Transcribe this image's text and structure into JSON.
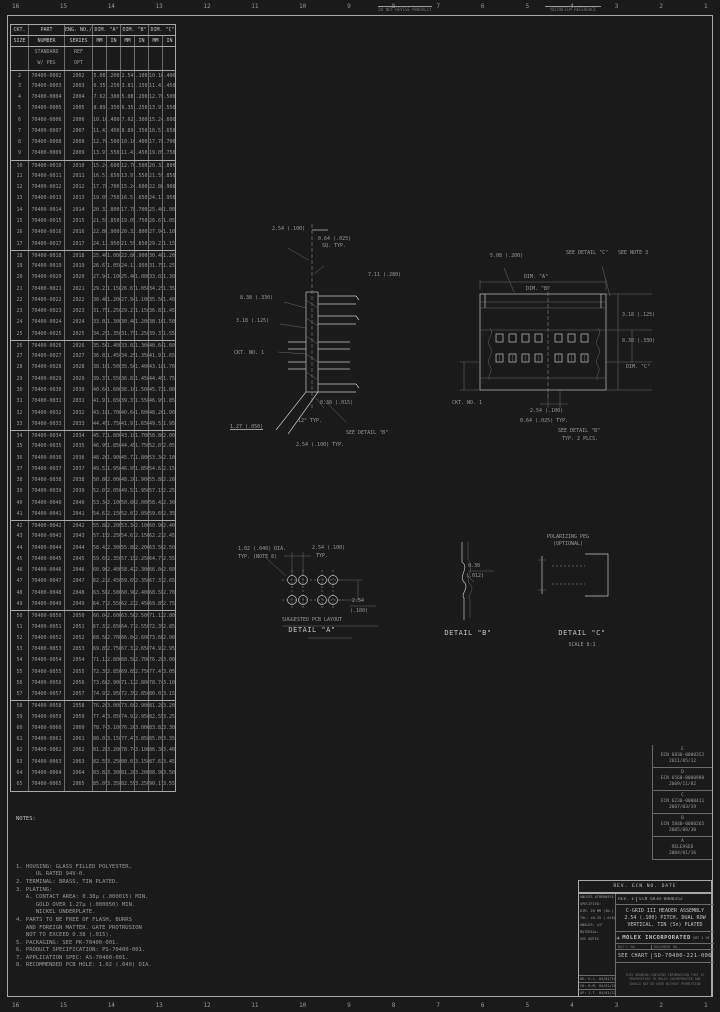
{
  "colors": {
    "bg": "#1a1a1a",
    "ink": "#c4c4c4",
    "dim": "#9a9a9a",
    "faint": "#707070",
    "line": "#a8a8a8",
    "grid": "#6b6b6b"
  },
  "border": {
    "zones": [
      "16",
      "15",
      "14",
      "13",
      "12",
      "11",
      "10",
      "9",
      "8",
      "7",
      "6",
      "5",
      "4",
      "3",
      "2",
      "1"
    ],
    "micro1": "DO NOT REVISE MANUALLY",
    "micro2": "MICROFILM REFERENCE"
  },
  "table": {
    "h1": {
      "ckt": "CKT.",
      "part": "PART",
      "eng": "ENG. NO./",
      "a": "DIM. \"A\"",
      "b": "DIM. \"B\"",
      "c": "DIM. \"C\""
    },
    "h2": {
      "ckt": "SIZE",
      "part": "NUMBER",
      "eng": "SERIES",
      "mm": "MM",
      "in": "IN"
    },
    "separators": [
      2,
      10,
      18,
      26,
      34,
      42,
      50,
      58
    ],
    "rows": [
      [
        "",
        "STANDARD",
        "REF",
        "",
        "",
        "",
        "",
        "",
        ""
      ],
      [
        "",
        "W/ PEG",
        "OPT",
        "",
        "",
        "",
        "",
        "",
        ""
      ],
      [
        "2",
        "70400-0002",
        "2002",
        "5.08",
        ".200",
        "2.54",
        ".100",
        "10.16",
        ".400"
      ],
      [
        "3",
        "70400-0003",
        "2003",
        "6.35",
        ".250",
        "3.81",
        ".150",
        "11.43",
        ".450"
      ],
      [
        "4",
        "70400-0004",
        "2004",
        "7.62",
        ".300",
        "5.08",
        ".200",
        "12.70",
        ".500"
      ],
      [
        "5",
        "70400-0005",
        "2005",
        "8.89",
        ".350",
        "6.35",
        ".250",
        "13.97",
        ".550"
      ],
      [
        "6",
        "70400-0006",
        "2006",
        "10.16",
        ".400",
        "7.62",
        ".300",
        "15.24",
        ".600"
      ],
      [
        "7",
        "70400-0007",
        "2007",
        "11.43",
        ".450",
        "8.89",
        ".350",
        "16.51",
        ".650"
      ],
      [
        "8",
        "70400-0008",
        "2008",
        "12.70",
        ".500",
        "10.16",
        ".400",
        "17.78",
        ".700"
      ],
      [
        "9",
        "70400-0009",
        "2009",
        "13.97",
        ".550",
        "11.43",
        ".450",
        "19.05",
        ".750"
      ],
      [
        "10",
        "70400-0010",
        "2010",
        "15.24",
        ".600",
        "12.70",
        ".500",
        "20.32",
        ".800"
      ],
      [
        "11",
        "70400-0011",
        "2011",
        "16.51",
        ".650",
        "13.97",
        ".550",
        "21.59",
        ".850"
      ],
      [
        "12",
        "70400-0012",
        "2012",
        "17.78",
        ".700",
        "15.24",
        ".600",
        "22.86",
        ".900"
      ],
      [
        "13",
        "70400-0013",
        "2013",
        "19.05",
        ".750",
        "16.51",
        ".650",
        "24.13",
        ".950"
      ],
      [
        "14",
        "70400-0014",
        "2014",
        "20.32",
        ".800",
        "17.78",
        ".700",
        "25.40",
        "1.000"
      ],
      [
        "15",
        "70400-0015",
        "2015",
        "21.59",
        ".850",
        "19.05",
        ".750",
        "26.67",
        "1.050"
      ],
      [
        "16",
        "70400-0016",
        "2016",
        "22.86",
        ".900",
        "20.32",
        ".800",
        "27.94",
        "1.100"
      ],
      [
        "17",
        "70400-0017",
        "2017",
        "24.13",
        ".950",
        "21.59",
        ".850",
        "29.21",
        "1.150"
      ],
      [
        "18",
        "70400-0018",
        "2018",
        "25.40",
        "1.000",
        "22.86",
        ".900",
        "30.48",
        "1.200"
      ],
      [
        "19",
        "70400-0019",
        "2019",
        "26.67",
        "1.050",
        "24.13",
        ".950",
        "31.75",
        "1.250"
      ],
      [
        "20",
        "70400-0020",
        "2020",
        "27.94",
        "1.100",
        "25.40",
        "1.000",
        "33.02",
        "1.300"
      ],
      [
        "21",
        "70400-0021",
        "2021",
        "29.21",
        "1.150",
        "26.67",
        "1.050",
        "34.29",
        "1.350"
      ],
      [
        "22",
        "70400-0022",
        "2022",
        "30.48",
        "1.200",
        "27.94",
        "1.100",
        "35.56",
        "1.400"
      ],
      [
        "23",
        "70400-0023",
        "2023",
        "31.75",
        "1.250",
        "29.21",
        "1.150",
        "36.83",
        "1.450"
      ],
      [
        "24",
        "70400-0024",
        "2024",
        "33.02",
        "1.300",
        "30.48",
        "1.200",
        "38.10",
        "1.500"
      ],
      [
        "25",
        "70400-0025",
        "2025",
        "34.29",
        "1.350",
        "31.75",
        "1.250",
        "39.37",
        "1.550"
      ],
      [
        "26",
        "70400-0026",
        "2026",
        "35.56",
        "1.400",
        "33.02",
        "1.300",
        "40.64",
        "1.600"
      ],
      [
        "27",
        "70400-0027",
        "2027",
        "36.83",
        "1.450",
        "34.29",
        "1.350",
        "41.91",
        "1.650"
      ],
      [
        "28",
        "70400-0028",
        "2028",
        "38.10",
        "1.500",
        "35.56",
        "1.400",
        "43.18",
        "1.700"
      ],
      [
        "29",
        "70400-0029",
        "2029",
        "39.37",
        "1.550",
        "36.83",
        "1.450",
        "44.45",
        "1.750"
      ],
      [
        "30",
        "70400-0030",
        "2030",
        "40.64",
        "1.600",
        "38.10",
        "1.500",
        "45.72",
        "1.800"
      ],
      [
        "31",
        "70400-0031",
        "2031",
        "41.91",
        "1.650",
        "39.37",
        "1.550",
        "46.99",
        "1.850"
      ],
      [
        "32",
        "70400-0032",
        "2032",
        "43.18",
        "1.700",
        "40.64",
        "1.600",
        "48.26",
        "1.900"
      ],
      [
        "33",
        "70400-0033",
        "2033",
        "44.45",
        "1.750",
        "41.91",
        "1.650",
        "49.53",
        "1.950"
      ],
      [
        "34",
        "70400-0034",
        "2034",
        "45.72",
        "1.800",
        "43.18",
        "1.700",
        "50.80",
        "2.000"
      ],
      [
        "35",
        "70400-0035",
        "2035",
        "46.99",
        "1.850",
        "44.45",
        "1.750",
        "52.07",
        "2.050"
      ],
      [
        "36",
        "70400-0036",
        "2036",
        "48.26",
        "1.900",
        "45.72",
        "1.800",
        "53.34",
        "2.100"
      ],
      [
        "37",
        "70400-0037",
        "2037",
        "49.53",
        "1.950",
        "46.99",
        "1.850",
        "54.61",
        "2.150"
      ],
      [
        "38",
        "70400-0038",
        "2038",
        "50.80",
        "2.000",
        "48.26",
        "1.900",
        "55.88",
        "2.200"
      ],
      [
        "39",
        "70400-0039",
        "2039",
        "52.07",
        "2.050",
        "49.53",
        "1.950",
        "57.15",
        "2.250"
      ],
      [
        "40",
        "70400-0040",
        "2040",
        "53.34",
        "2.100",
        "50.80",
        "2.000",
        "58.42",
        "2.300"
      ],
      [
        "41",
        "70400-0041",
        "2041",
        "54.61",
        "2.150",
        "52.07",
        "2.050",
        "59.69",
        "2.350"
      ],
      [
        "42",
        "70400-0042",
        "2042",
        "55.88",
        "2.200",
        "53.34",
        "2.100",
        "60.96",
        "2.400"
      ],
      [
        "43",
        "70400-0043",
        "2043",
        "57.15",
        "2.250",
        "54.61",
        "2.150",
        "62.23",
        "2.450"
      ],
      [
        "44",
        "70400-0044",
        "2044",
        "58.42",
        "2.300",
        "55.88",
        "2.200",
        "63.50",
        "2.500"
      ],
      [
        "45",
        "70400-0045",
        "2045",
        "59.69",
        "2.350",
        "57.15",
        "2.250",
        "64.77",
        "2.550"
      ],
      [
        "46",
        "70400-0046",
        "2046",
        "60.96",
        "2.400",
        "58.42",
        "2.300",
        "66.04",
        "2.600"
      ],
      [
        "47",
        "70400-0047",
        "2047",
        "62.23",
        "2.450",
        "59.69",
        "2.350",
        "67.31",
        "2.650"
      ],
      [
        "48",
        "70400-0048",
        "2048",
        "63.50",
        "2.500",
        "60.96",
        "2.400",
        "68.58",
        "2.700"
      ],
      [
        "49",
        "70400-0049",
        "2049",
        "64.77",
        "2.550",
        "62.23",
        "2.450",
        "69.85",
        "2.750"
      ],
      [
        "50",
        "70400-0050",
        "2050",
        "66.04",
        "2.600",
        "63.50",
        "2.500",
        "71.12",
        "2.800"
      ],
      [
        "51",
        "70400-0051",
        "2051",
        "67.31",
        "2.650",
        "64.77",
        "2.550",
        "72.39",
        "2.850"
      ],
      [
        "52",
        "70400-0052",
        "2052",
        "68.58",
        "2.700",
        "66.04",
        "2.600",
        "73.66",
        "2.900"
      ],
      [
        "53",
        "70400-0053",
        "2053",
        "69.85",
        "2.750",
        "67.31",
        "2.650",
        "74.93",
        "2.950"
      ],
      [
        "54",
        "70400-0054",
        "2054",
        "71.12",
        "2.800",
        "68.58",
        "2.700",
        "76.20",
        "3.000"
      ],
      [
        "55",
        "70400-0055",
        "2055",
        "72.39",
        "2.850",
        "69.85",
        "2.750",
        "77.47",
        "3.050"
      ],
      [
        "56",
        "70400-0056",
        "2056",
        "73.66",
        "2.900",
        "71.12",
        "2.800",
        "78.74",
        "3.100"
      ],
      [
        "57",
        "70400-0057",
        "2057",
        "74.93",
        "2.950",
        "72.39",
        "2.850",
        "80.01",
        "3.150"
      ],
      [
        "58",
        "70400-0058",
        "2058",
        "76.20",
        "3.000",
        "73.66",
        "2.900",
        "81.28",
        "3.200"
      ],
      [
        "59",
        "70400-0059",
        "2059",
        "77.47",
        "3.050",
        "74.93",
        "2.950",
        "82.55",
        "3.250"
      ],
      [
        "60",
        "70400-0060",
        "2060",
        "78.74",
        "3.100",
        "76.20",
        "3.000",
        "83.82",
        "3.300"
      ],
      [
        "61",
        "70400-0061",
        "2061",
        "80.01",
        "3.150",
        "77.47",
        "3.050",
        "85.09",
        "3.350"
      ],
      [
        "62",
        "70400-0062",
        "2062",
        "81.28",
        "3.200",
        "78.74",
        "3.100",
        "86.36",
        "3.400"
      ],
      [
        "63",
        "70400-0063",
        "2063",
        "82.55",
        "3.250",
        "80.01",
        "3.150",
        "87.63",
        "3.450"
      ],
      [
        "64",
        "70400-0064",
        "2064",
        "83.82",
        "3.300",
        "81.28",
        "3.200",
        "88.90",
        "3.500"
      ],
      [
        "65",
        "70400-0065",
        "2065",
        "85.09",
        "3.350",
        "82.55",
        "3.250",
        "90.17",
        "3.550"
      ]
    ]
  },
  "drawings": {
    "side": {
      "s1": "2.54 (.100)",
      "s2": "0.64 (.025)",
      "s3": "SQ. TYP.",
      "s4": "7.11 (.280)",
      "s5": "8.38 (.330)",
      "s6": "3.18 (.125)",
      "s7": "CKT. NO. 1",
      "s8": "0.38 (.015)",
      "s9": "12° TYP.",
      "s10": "1.27 (.050)",
      "s11": "SEE DETAIL \"B\"",
      "s12": "2.54 (.100) TYP."
    },
    "top": {
      "t1": "5.08 (.200)",
      "t2": "SEE DETAIL \"C\"",
      "t3": "DIM. \"A\"",
      "t4": "DIM. \"B\"",
      "t5": "SEE NOTE 3",
      "t6": "3.18 (.125)",
      "t7": "8.38 (.330)",
      "t8": "DIM. \"C\"",
      "t9": "2.54 (.100)",
      "t10": "0.64 (.025) TYP.",
      "t11": "CKT. NO. 1",
      "t12": "SEE DETAIL \"B\"",
      "t13": "TYP. 2 PLCS."
    },
    "pcb": {
      "p1": "1.02 (.040) DIA.",
      "p2": "TYP. (NOTE 8)",
      "p3": "2.54 (.100)",
      "p4": "TYP.",
      "p5": "2.54",
      "p6": "(.100)",
      "title1": "SUGGESTED PCB LAYOUT",
      "title2": "DETAIL \"A\""
    },
    "detail_b": {
      "d1": "0.30",
      "d2": "(.012)",
      "title": "DETAIL \"B\""
    },
    "detail_c": {
      "c1": "POLARIZING PEG",
      "c2": "(OPTIONAL)",
      "title": "DETAIL \"C\"",
      "scale": "SCALE 8:1"
    }
  },
  "notes": {
    "title": "NOTES:",
    "lines": [
      "1. HOUSING: GLASS FILLED POLYESTER,",
      "      UL RATED 94V-0.",
      "",
      "2. TERMINAL: BRASS, TIN PLATED.",
      "",
      "3. PLATING:",
      "   A. CONTACT AREA: 0.38µ (.000015) MIN.",
      "      GOLD OVER 1.27µ (.000050) MIN.",
      "      NICKEL UNDERPLATE.",
      "",
      "4. PARTS TO BE FREE OF FLASH, BURRS",
      "   AND FOREIGN MATTER. GATE PROTRUSION",
      "   NOT TO EXCEED 0.38 (.015).",
      "",
      "5. PACKAGING: SEE PK-70400-001.",
      "",
      "6. PRODUCT SPECIFICATION: PS-70400-001.",
      "",
      "7. APPLICATION SPEC: AS-70400-001.",
      "8. RECOMMENDED PCB HOLE: 1.02 (.040) DIA."
    ]
  },
  "revisions": {
    "header": "REV.  ECN NO.  DATE",
    "entries": [
      "E\nECN 6830-0000352\n2011/05/12",
      "D\nECN 6560-0000988\n2009/11/02",
      "C\nECN 6230-0000411\n2007/03/19",
      "B\nECN 5840-0000265\n2005/08/30",
      "A\nRELEASED\n2004/01/16"
    ]
  },
  "title_block": {
    "rev_label": "REV. E",
    "ecn": "ECN 6830-0000352",
    "title_line1": "C-GRID III HEADER ASSEMBLY",
    "title_line2": "2.54 (.100) PITCH, DUAL ROW",
    "title_line3": "VERTICAL, TIN (Sn) PLATED",
    "logo_glyph": "✳",
    "brand": "MOLEX INCORPORATED",
    "sheet": "SHT 1 OF 1",
    "material_label": "MAT'L NO.",
    "doc_label": "DOCUMENT NO.",
    "material": "SEE CHART",
    "doc": "SD-70400-221-006",
    "left_lines": [
      "UNLESS OTHERWISE",
      "SPECIFIED:",
      "DIM. IN MM (IN.)",
      "TOL: ±0.25 (.010)",
      "ANGLES: ±3°",
      "MATERIAL:",
      "SEE NOTES"
    ],
    "signoffs": [
      "DR: K.L. 04/01/16",
      "CH: R.M. 04/01/20",
      "AP: J.T. 04/01/22"
    ],
    "fine_print": [
      "THIS DRAWING CONTAINS INFORMATION THAT IS",
      "PROPRIETARY TO MOLEX INCORPORATED AND",
      "SHOULD NOT BE USED WITHOUT PERMISSION"
    ]
  }
}
